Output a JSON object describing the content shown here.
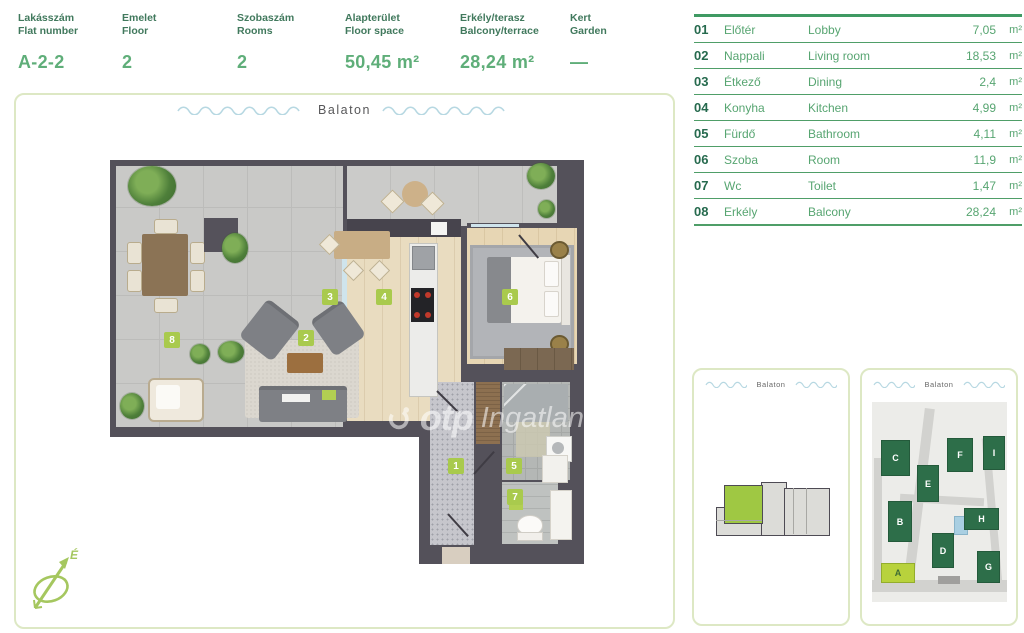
{
  "header": {
    "fields": [
      {
        "label": "Lakásszám",
        "sublabel": "Flat number",
        "value": "A-2-2"
      },
      {
        "label": "Emelet",
        "sublabel": "Floor",
        "value": "2"
      },
      {
        "label": "Szobaszám",
        "sublabel": "Rooms",
        "value": "2"
      },
      {
        "label": "Alapterület",
        "sublabel": "Floor space",
        "value": "50,45 m²"
      },
      {
        "label": "Erkély/terasz",
        "sublabel": "Balcony/terrace",
        "value": "28,24 m²"
      },
      {
        "label": "Kert",
        "sublabel": "Garden",
        "value": "—"
      }
    ]
  },
  "room_table": {
    "rows": [
      {
        "num": "01",
        "name_hu": "Előtér",
        "name_en": "Lobby",
        "area": "7,05",
        "unit": "m²"
      },
      {
        "num": "02",
        "name_hu": "Nappali",
        "name_en": "Living room",
        "area": "18,53",
        "unit": "m²"
      },
      {
        "num": "03",
        "name_hu": "Étkező",
        "name_en": "Dining",
        "area": "2,4",
        "unit": "m²"
      },
      {
        "num": "04",
        "name_hu": "Konyha",
        "name_en": "Kitchen",
        "area": "4,99",
        "unit": "m²"
      },
      {
        "num": "05",
        "name_hu": "Fürdő",
        "name_en": "Bathroom",
        "area": "4,11",
        "unit": "m²"
      },
      {
        "num": "06",
        "name_hu": "Szoba",
        "name_en": "Room",
        "area": "11,9",
        "unit": "m²"
      },
      {
        "num": "07",
        "name_hu": "Wc",
        "name_en": "Toilet",
        "area": "1,47",
        "unit": "m²"
      },
      {
        "num": "08",
        "name_hu": "Erkély",
        "name_en": "Balcony",
        "area": "28,24",
        "unit": "m²"
      }
    ]
  },
  "floorplan": {
    "location_label": "Balaton",
    "watermark": {
      "brand": "otp",
      "suffix": "Ingatlan"
    },
    "compass_label": "É",
    "room_badges": [
      "1",
      "2",
      "3",
      "4",
      "5",
      "6",
      "7",
      "8"
    ]
  },
  "thumbnails": {
    "floor_thumb": {
      "location_label": "Balaton"
    },
    "site_thumb": {
      "location_label": "Balaton",
      "buildings": [
        {
          "label": "C"
        },
        {
          "label": "F"
        },
        {
          "label": "I"
        },
        {
          "label": "E"
        },
        {
          "label": "B"
        },
        {
          "label": "H"
        },
        {
          "label": "D"
        },
        {
          "label": "G"
        },
        {
          "label": "A",
          "highlight": true
        }
      ]
    }
  },
  "colors": {
    "accent_green": "#57a571",
    "dark_green": "#266a4e",
    "lime": "#a9ca4d",
    "panel_border": "#dde8c4",
    "wall": "#54515a",
    "wave_blue": "#b7d8e2",
    "building_green": "#2d6e49",
    "highlight_lime": "#b8d23c"
  }
}
